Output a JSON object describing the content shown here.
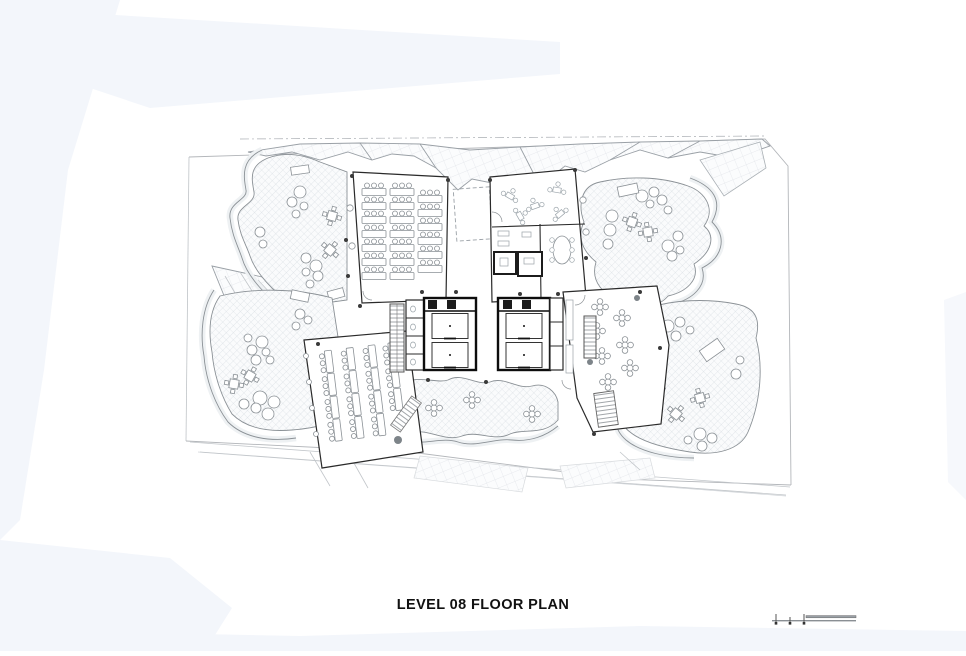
{
  "sheet": {
    "title": "LEVEL 08 FLOOR PLAN",
    "background_color": "#ffffff",
    "margin_tint_color": "#f3f6fb",
    "wall_color": "#1f1f1f",
    "furniture_color": "#8b9196",
    "hatch_color": "#ccd3d9"
  },
  "scale_bar": {
    "icon": "graphic-scale-icon"
  }
}
